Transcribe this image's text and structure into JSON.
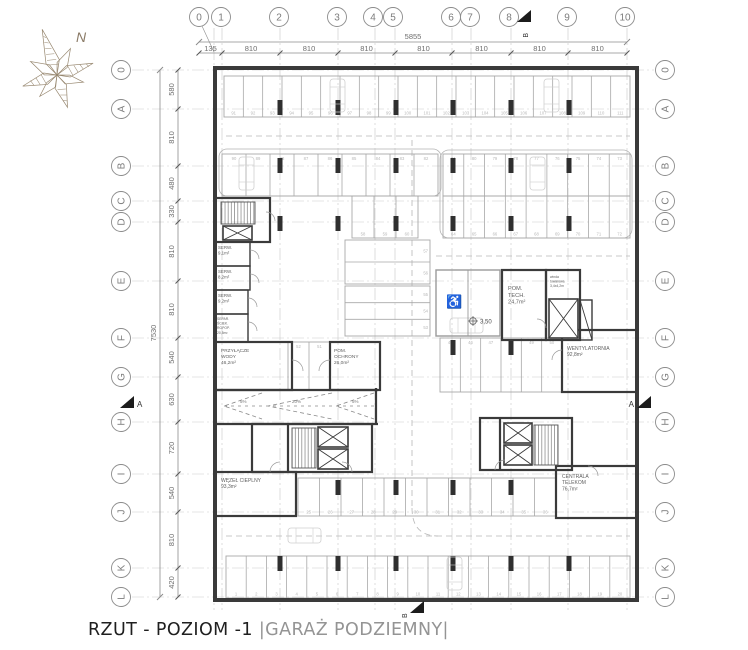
{
  "title": {
    "main": "RZUT - POZIOM -1",
    "secondary": "|GARAŻ PODZIEMNY|"
  },
  "compass": {
    "north": "N"
  },
  "axes": {
    "top": [
      "0",
      "1",
      "2",
      "3",
      "4",
      "5",
      "6",
      "7",
      "8",
      "9",
      "10"
    ],
    "side": [
      "0",
      "A",
      "B",
      "C",
      "D",
      "E",
      "F",
      "G",
      "H",
      "I",
      "J",
      "K",
      "L"
    ]
  },
  "dims": {
    "top_total": "5855",
    "top_segments": [
      "135",
      "810",
      "810",
      "810",
      "810",
      "810",
      "810",
      "810"
    ],
    "side_total": "7530",
    "side_segments": [
      "580",
      "810",
      "480",
      "330",
      "810",
      "810",
      "540",
      "630",
      "720",
      "540",
      "810",
      "420"
    ]
  },
  "markers": {
    "section_a": "A",
    "section_b": "B"
  },
  "level_marker": "3,50",
  "ramp": {
    "slopes": [
      "5%",
      "20%",
      "5%"
    ]
  },
  "rooms": [
    {
      "id": "serw1",
      "name": "SERW.",
      "area": "9,1m²"
    },
    {
      "id": "serw2",
      "name": "SERW.",
      "area": "8,2m²"
    },
    {
      "id": "serw3",
      "name": "SERW.",
      "area": "9,2m²"
    },
    {
      "id": "separ",
      "name": "SEPAR. ŚCIEK. ROPOP.",
      "area": "20,5m²"
    },
    {
      "id": "woda",
      "name": "PRZYŁĄCZE WODY",
      "area": "46,2m²"
    },
    {
      "id": "ochrona",
      "name": "POM. OCHRONY",
      "area": "26,0m²"
    },
    {
      "id": "tech",
      "name": "POM. TECH.",
      "area": "24,7m²"
    },
    {
      "id": "winda",
      "name": "winda towarowa",
      "area": "3,4x4,2m"
    },
    {
      "id": "went",
      "name": "WENTYLATORNIA",
      "area": "92,8m²"
    },
    {
      "id": "wezel",
      "name": "WĘZEŁ CIEPLNY",
      "area": "93,3m²"
    },
    {
      "id": "telekom",
      "name": "CENTRALA TELEKOM",
      "area": "76,7m²"
    }
  ],
  "parking": {
    "row_top": {
      "from": 91,
      "to": 111
    },
    "row_mid_upper_left": {
      "from": 90,
      "to": 82
    },
    "row_mid_upper_right": {
      "from": 81,
      "to": 73
    },
    "row_mid_lower_right": {
      "from": 64,
      "to": 72
    },
    "row_mid_small": {
      "from": 58,
      "to": 60
    },
    "row_ef": {
      "from": 45,
      "to": 50
    },
    "pair_51_52": {
      "from": 52,
      "to": 51
    },
    "row_bottom_upper": {
      "from": 25,
      "to": 36
    },
    "row_bottom": {
      "from": 1,
      "to": 20
    },
    "stack_upper": {
      "from": 57,
      "to": 56
    },
    "stack_lower": {
      "from": 55,
      "to": 53
    }
  }
}
